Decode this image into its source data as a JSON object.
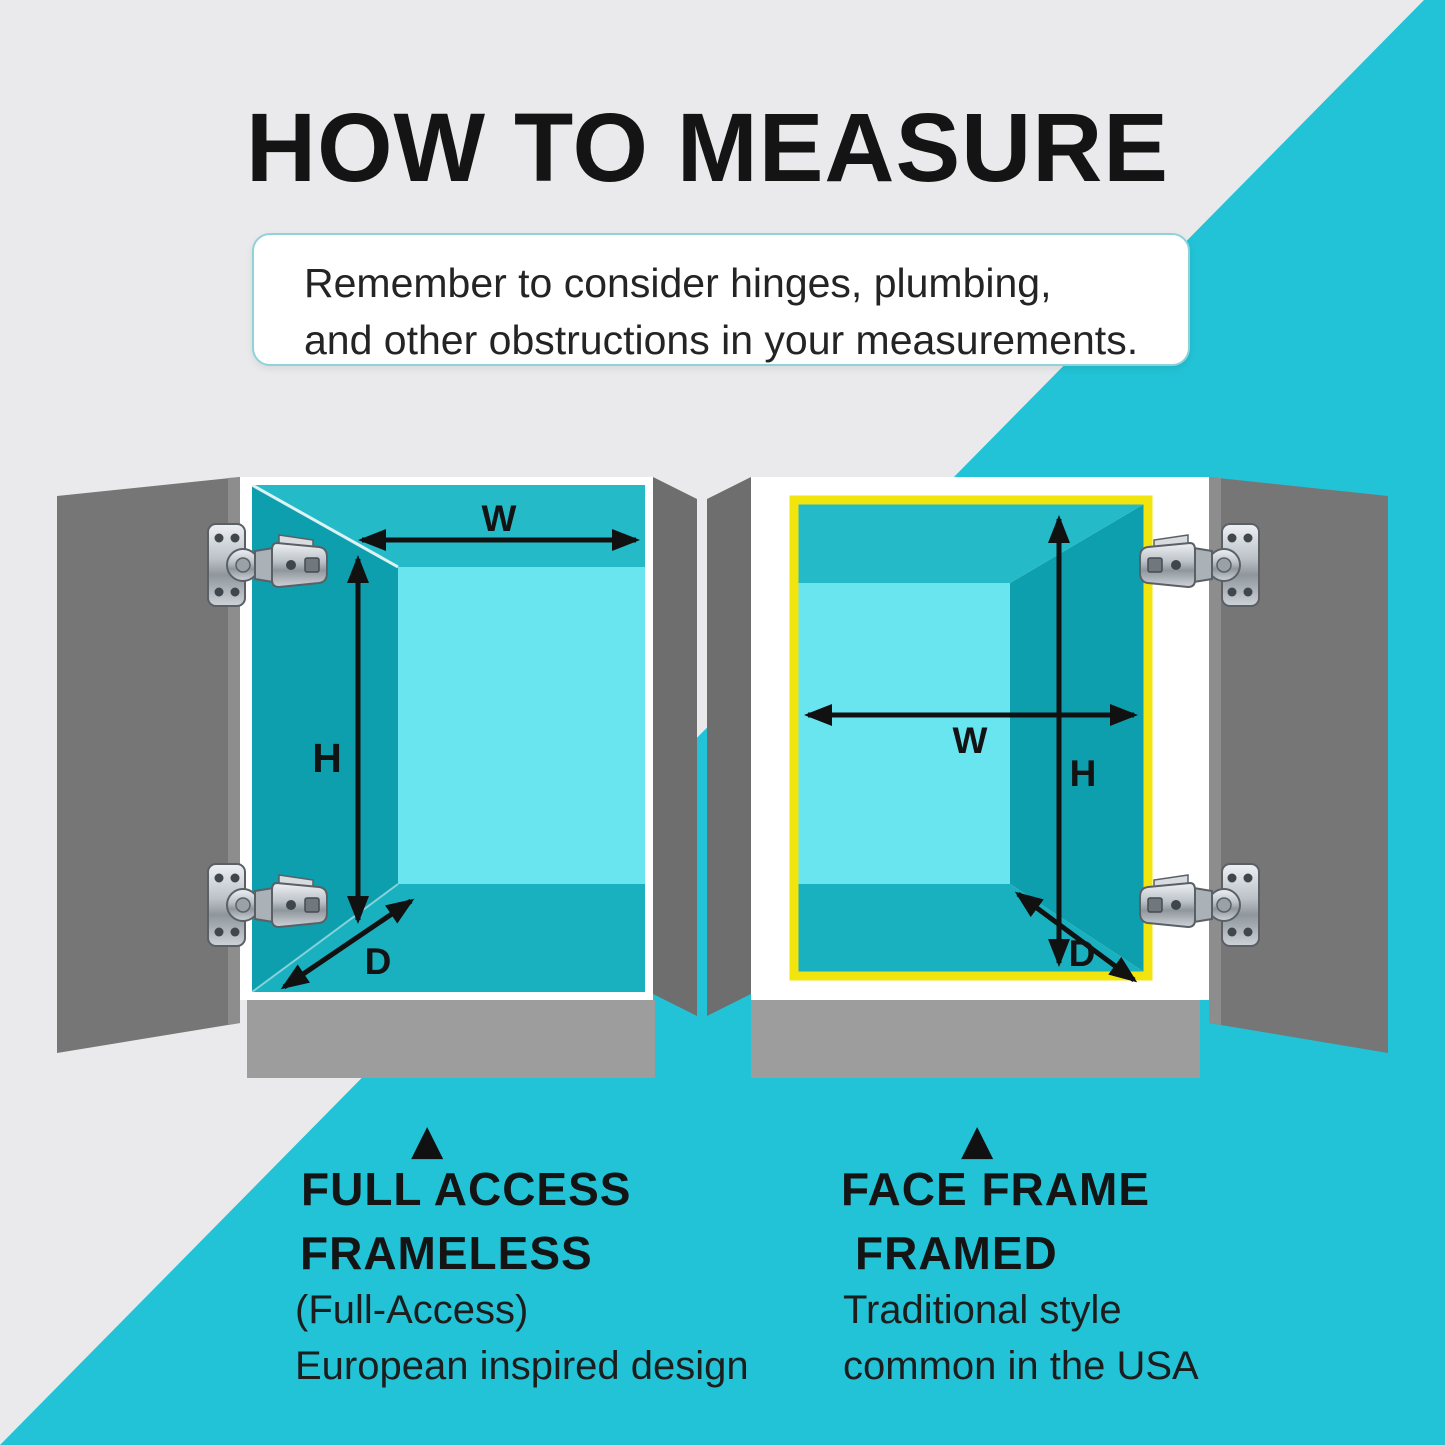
{
  "title": "HOW TO MEASURE",
  "note": {
    "line1": "Remember to consider hinges, plumbing,",
    "line2": "and other obstructions in your measurements."
  },
  "dimension_labels": {
    "width": "W",
    "height": "H",
    "depth": "D"
  },
  "cabinets": {
    "left": {
      "pointer": "▲",
      "type_label": "FULL ACCESS",
      "style_name": "FRAMELESS",
      "style_detail_1": "(Full-Access)",
      "style_detail_2": "European inspired design"
    },
    "right": {
      "pointer": "▲",
      "type_label": "FACE FRAME",
      "style_name": "FRAMED",
      "style_detail_1": "Traditional style",
      "style_detail_2": "common in the USA"
    }
  },
  "colors": {
    "background_gray": "#eaeaec",
    "teal_accent": "#22c3d6",
    "interior_back_wall": "#69e5f0",
    "interior_dark_wall": "#0d9fae",
    "interior_top_wall": "#25bac8",
    "interior_bottom_wall": "#19b0bf",
    "door_gray": "#767676",
    "base_gray": "#9d9d9d",
    "face_frame_yellow": "#f2e50e",
    "arrow_black": "#111111"
  }
}
